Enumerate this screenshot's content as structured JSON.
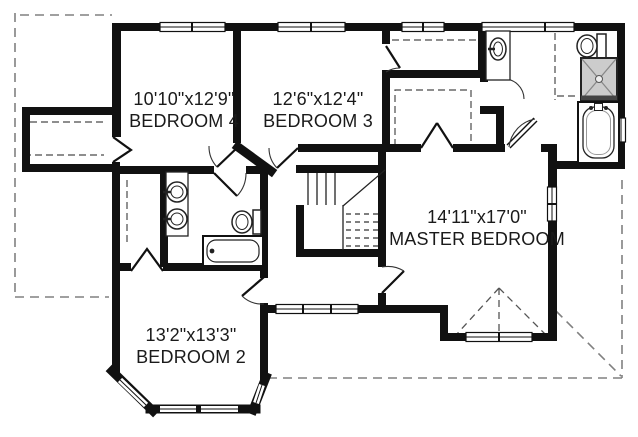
{
  "plan": {
    "type": "second-floor-plan",
    "rooms": [
      {
        "id": "bedroom-4",
        "dims": "10'10\"x12'9\"",
        "name": "BEDROOM 4"
      },
      {
        "id": "bedroom-3",
        "dims": "12'6\"x12'4\"",
        "name": "BEDROOM 3"
      },
      {
        "id": "master-bedroom",
        "dims": "14'11\"x17'0\"",
        "name": "MASTER BEDROOM"
      },
      {
        "id": "bedroom-2",
        "dims": "13'2\"x13'3\"",
        "name": "BEDROOM 2"
      }
    ],
    "fixtures": {
      "hall_bathroom": [
        "double-vanity-sink",
        "double-vanity-sink",
        "toilet",
        "bathtub"
      ],
      "master_bathroom": [
        "vanity-sink",
        "toilet",
        "shower",
        "bathtub"
      ]
    },
    "features": [
      "staircase-with-dashed-lower-flight",
      "master-walk-in-closet-dashed-shelves",
      "bedroom3-closet-dashed-shelf",
      "bedroom4-dormer-closet",
      "bedroom2-bifold-closet",
      "bay-window-bedroom2",
      "gable-dashed-rooflines"
    ],
    "colors": {
      "wall": "#111111",
      "background": "#ffffff",
      "roofline_dash": "#808080",
      "interior_dash": "#555555",
      "shower_fill": "#cccccc",
      "text": "#1a1a1a"
    }
  }
}
